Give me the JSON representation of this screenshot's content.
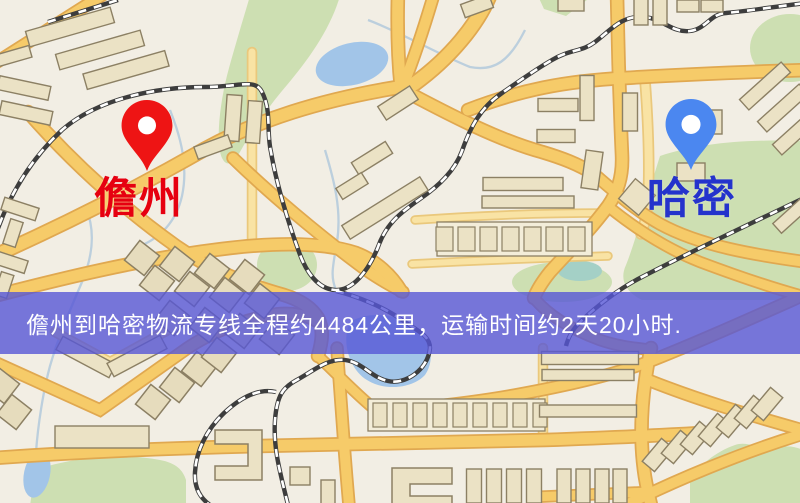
{
  "map": {
    "origin": {
      "name": "儋州",
      "marker_color": "#ee1414",
      "label_color": "#e60010"
    },
    "destination": {
      "name": "哈密",
      "marker_color": "#4b87f0",
      "label_color": "#2433cc"
    },
    "banner": {
      "text": "儋州到哈密物流专线全程约4484公里，运输时间约2天20小时.",
      "distance_km": "4484",
      "duration": "2天20小时",
      "background_color": "rgba(86,86,214,0.80)",
      "text_color": "#ffffff"
    },
    "colors": {
      "land": "#f2eee4",
      "park": "#cddfb2",
      "teal_water": "#a4d0c6",
      "water": "#a2c5e8",
      "stream": "#bccfdd",
      "road_major": "#f6cb69",
      "road_major_casing": "#e0a850",
      "road_minor": "#f9e3a4",
      "road_minor_casing": "#eac87c",
      "railway": "#3d3d3d",
      "railway_dash": "#ffffff",
      "building": "#ebe2c5",
      "building_dark": "#e6dcbd",
      "building_outline": "#8c8064",
      "strip": "#f3edd9"
    }
  }
}
